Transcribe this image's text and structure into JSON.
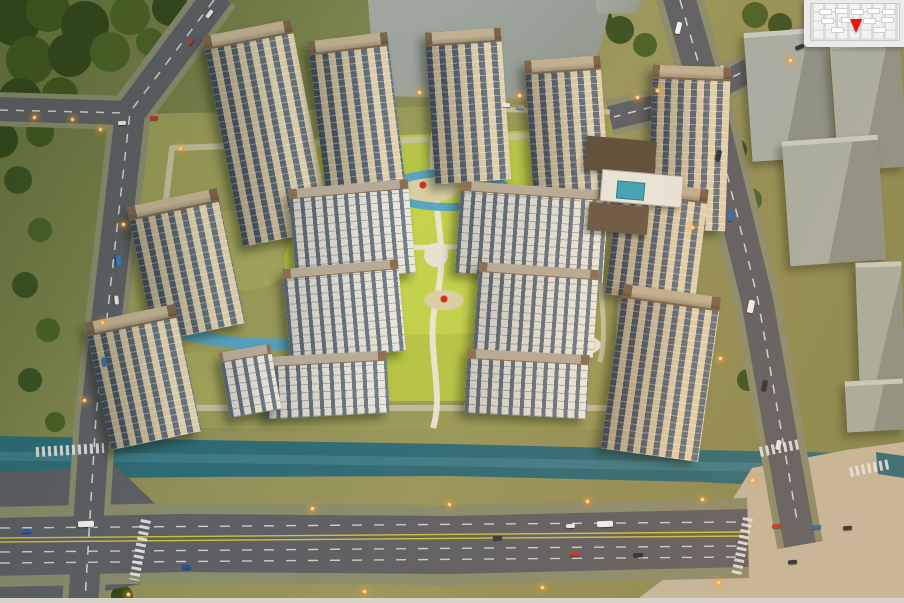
{
  "meta": {
    "image_type": "aerial architectural rendering",
    "description": "Dusk bird's-eye masterplan rendering of a riverside residential compound: beige high-rise towers and white mid-rise slabs around a landscaped central park, bounded by tree-lined avenues, a teal canal along the south edge and grey context building blocks to the east",
    "time_of_day": "dusk"
  },
  "palette": {
    "facade_beige": "#d7c8a8",
    "glass_blue": "#43536a",
    "roof_brown": "#7d654c",
    "roof_light": "#c0b091",
    "slab_facade": "#e9e6de",
    "slab_glass": "#5c6c7c",
    "slab_roof": "#8a7054",
    "river_teal": "#2f6c78",
    "stream_blue": "#54a2c4",
    "pool_teal": "#3fa3b8",
    "lawn_green": "#b6c547",
    "parcel_olive": "#9a9b58",
    "asphalt": "#5e6065",
    "sidewalk": "#8a8c6e",
    "beige_paving": "#c2b8a0",
    "forest_green": "#35491d",
    "tree_yellow": "#d9b844",
    "tree_pink": "#cf9aa8",
    "playground_red": "#d0301f",
    "marker_red": "#e8150d",
    "street_light": "#ffa53e",
    "marking_white": "#e8e8e8",
    "marking_yellow": "#cfc13e",
    "context_gray": "#9aa29a",
    "inset_bg": "#ebebe9"
  },
  "scene": {
    "residential_towers": 9,
    "midrise_slabs": 4,
    "lowrise_slabs": 3,
    "clubhouse": {
      "flat_roof_pavilions": 3,
      "swimming_pool": true
    },
    "context_massing_blocks": 6,
    "playground_structures": 2,
    "roads": [
      "northwest diagonal avenue",
      "south riverside boulevard",
      "east arterial road",
      "northeast cross street"
    ],
    "water_features": [
      "riverside canal",
      "looping landscape streams",
      "clubhouse pool"
    ],
    "inset_map": {
      "position": "top-right corner",
      "style": "faint grey site plan",
      "marker": "red downward location arrow"
    }
  }
}
